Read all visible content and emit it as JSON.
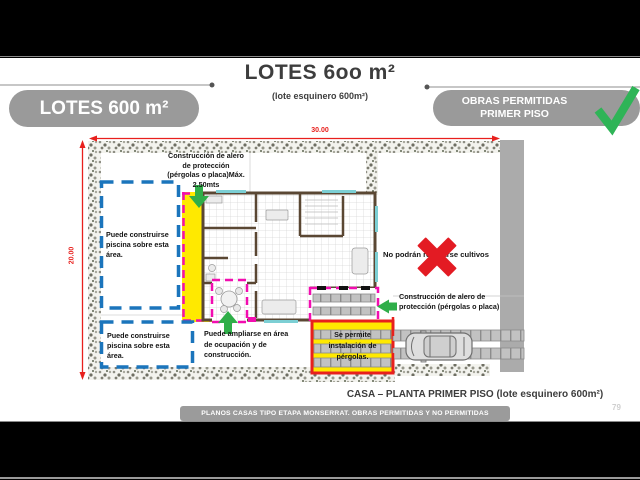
{
  "header": {
    "title": "LOTES 6oo m²",
    "subtitle": "(lote esquinero 600m²)",
    "left_badge": "LOTES 600 m²",
    "right_badge": {
      "line1": "OBRAS PERMITIDAS",
      "line2": "PRIMER PISO"
    }
  },
  "plan": {
    "width_dimension": "30.00",
    "height_dimension": "20.00",
    "annotations": {
      "alero_top": "Construcción de alero\nde protección\n(pérgolas o placa)Máx.\n2.50mts",
      "pool_area_1": "Puede construirse\npiscina sobre esta\nárea.",
      "pool_area_2": "Puede construirse\npiscina sobre esta\nárea.",
      "expansion": "Puede ampliarse en área\nde ocupación y de\nconstrucción.",
      "no_crops": "No podrán realizarse cultivos",
      "alero_right": "Construcción de alero de\nprotección (pérgolas o placa)",
      "pergolas_allowed": "Se permite\ninstalación de\npérgolas."
    },
    "caption": "CASA – PLANTA PRIMER PISO (lote esquinero 600m²)"
  },
  "footer": {
    "banner": "PLANOS CASAS TIPO ETAPA MONSERRAT. OBRAS PERMITIDAS Y NO PERMITIDAS",
    "page_number": "79"
  },
  "icons": {
    "check": "check-icon",
    "red_x": "red-x-icon",
    "arrow_down": "arrow-down-icon",
    "arrow_up": "arrow-up-icon",
    "arrow_left": "arrow-left-icon",
    "car": "car-top-view-icon"
  },
  "colors": {
    "badge_gray": "#9a9a9a",
    "highlight_yellow": "#ffe900",
    "overlay_magenta": "#f20db0",
    "overlay_blue": "#1b75bc",
    "arrow_green": "#2fae49",
    "alert_red": "#e31b23",
    "dimension_red": "#e8201d",
    "street_gray": "#ababab",
    "wall_brown": "#5a4733",
    "window_cyan": "#7ccfd4"
  }
}
